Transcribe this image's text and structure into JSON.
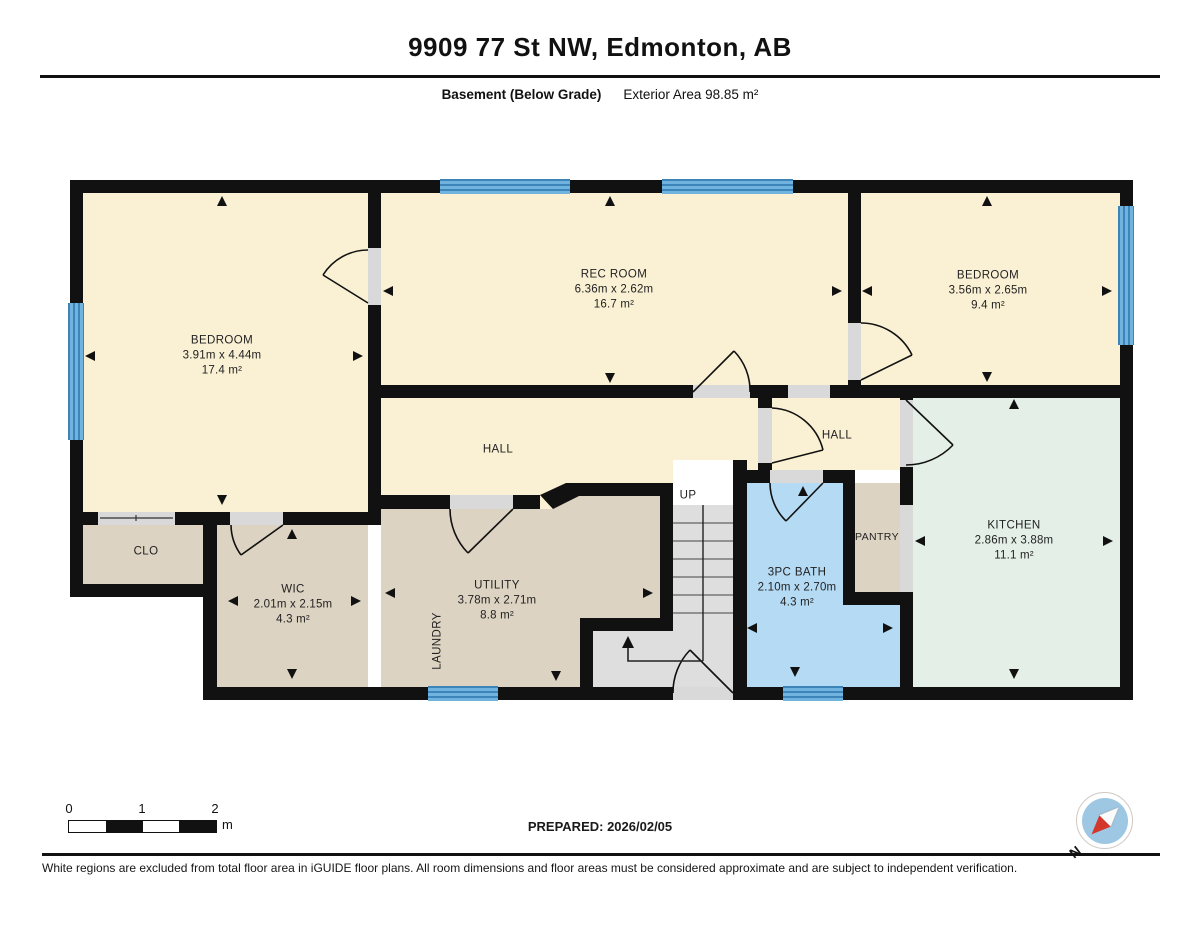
{
  "header": {
    "title": "9909 77 St NW, Edmonton, AB",
    "floor_label": "Basement (Below Grade)",
    "area_label": "Exterior Area 98.85 m²"
  },
  "rooms": {
    "bedroom_left": {
      "name": "BEDROOM",
      "dims": "3.91m x 4.44m",
      "area": "17.4 m²"
    },
    "rec_room": {
      "name": "REC ROOM",
      "dims": "6.36m x 2.62m",
      "area": "16.7 m²"
    },
    "bedroom_right": {
      "name": "BEDROOM",
      "dims": "3.56m x 2.65m",
      "area": "9.4 m²"
    },
    "hall_left": {
      "name": "HALL"
    },
    "hall_right": {
      "name": "HALL"
    },
    "kitchen": {
      "name": "KITCHEN",
      "dims": "2.86m x 3.88m",
      "area": "11.1 m²"
    },
    "pantry": {
      "name": "PANTRY"
    },
    "bath": {
      "name": "3PC BATH",
      "dims": "2.10m x 2.70m",
      "area": "4.3 m²"
    },
    "closet": {
      "name": "CLO"
    },
    "wic": {
      "name": "WIC",
      "dims": "2.01m x 2.15m",
      "area": "4.3 m²"
    },
    "utility": {
      "name": "UTILITY",
      "dims": "3.78m x 2.71m",
      "area": "8.8 m²"
    },
    "laundry": {
      "name": "LAUNDRY"
    },
    "stairs": {
      "label": "UP"
    }
  },
  "scale_bar": {
    "ticks": [
      "0",
      "1",
      "2"
    ],
    "unit": "m"
  },
  "compass": {
    "north_label": "N"
  },
  "footer": {
    "prepared": "PREPARED: 2026/02/05",
    "disclaimer": "White regions are excluded from total floor area in iGUIDE floor plans. All room dimensions and floor areas must be considered approximate and are subject to independent verification."
  },
  "colors": {
    "wall": "#111111",
    "room_cream": "#FAF1D4",
    "room_tan": "#DDD3C2",
    "room_mint": "#E4EFE7",
    "room_bath_blue": "#B5DAF3",
    "window_blue": "#58A5D6",
    "stairs_gray": "#DEDEDE",
    "compass_red": "#D3362B"
  }
}
